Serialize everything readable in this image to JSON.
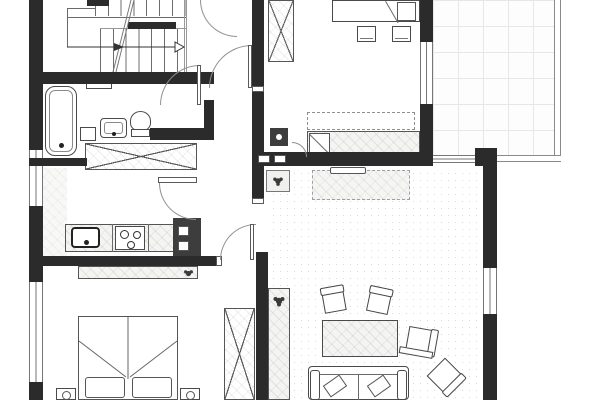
{
  "meta": {
    "width": 600,
    "height": 400,
    "kind": "architectural-floor-plan",
    "visible_text": "none"
  },
  "palette": {
    "wall": "#2b2b2b",
    "furniture_line": "#4a4a4a",
    "door_arc": "#909090",
    "hatch_fill": "#f4f4f2",
    "balcony_grid": "#e5e7e9",
    "paper_dots": "#dcdcdc",
    "background": "#ffffff"
  },
  "rooms": [
    {
      "id": "staircase",
      "label": "Staircase"
    },
    {
      "id": "bathroom",
      "label": "Bathroom"
    },
    {
      "id": "hallway",
      "label": "Hallway"
    },
    {
      "id": "kitchen",
      "label": "Kitchen"
    },
    {
      "id": "bedroom-top",
      "label": "Bedroom (top right)"
    },
    {
      "id": "daybed-room",
      "label": "Room with single bed"
    },
    {
      "id": "bedroom-bottom",
      "label": "Bedroom (bottom left)"
    },
    {
      "id": "living-room",
      "label": "Living room"
    },
    {
      "id": "balcony",
      "label": "Balcony / terrace"
    }
  ],
  "items": {
    "staircase": "Staircase with up-direction arrow",
    "bathtub": "Bathtub",
    "bath_shelf": "Bathroom shelf",
    "washing_machine": "Washing machine",
    "washbasin": "Washbasin",
    "toilet": "Toilet",
    "hall_wardrobe": "Built-in wardrobe (crossed)",
    "kitchen_counter": "Kitchen counter",
    "kitchen_sink": "Kitchen sink",
    "cooktop": "Cooktop with burners",
    "service_shaft": "Service shaft",
    "vent_shaft": "Ventilation shaft",
    "floor_unit": "Floor unit with plant",
    "overhead_cabinet": "Overhead cabinet (dashed)",
    "daybed": "Single bed with pillow",
    "sideboard_dashed": "Low sideboard (dashed outline)",
    "wall_shelf": "Wall shelf",
    "coffee_table": "Coffee table",
    "chair": "Chair",
    "side_shelf": "Side shelf",
    "sofa": "Sofa with cushions",
    "bookshelf": "Tall shelf with plant",
    "dresser": "Dresser with plant",
    "double_bed": "Double bed",
    "nightstand": "Nightstand with lamp",
    "bedroom_wardrobe": "Wardrobe (crossed)",
    "top_wardrobe": "Wardrobe (crossed)",
    "top_bed": "Bed (partly cut at top edge)",
    "stool": "Stool / pouf",
    "balcony_floor": "Tiled balcony floor",
    "railing": "Balcony railing",
    "window": "Window",
    "door": "Door swing"
  }
}
